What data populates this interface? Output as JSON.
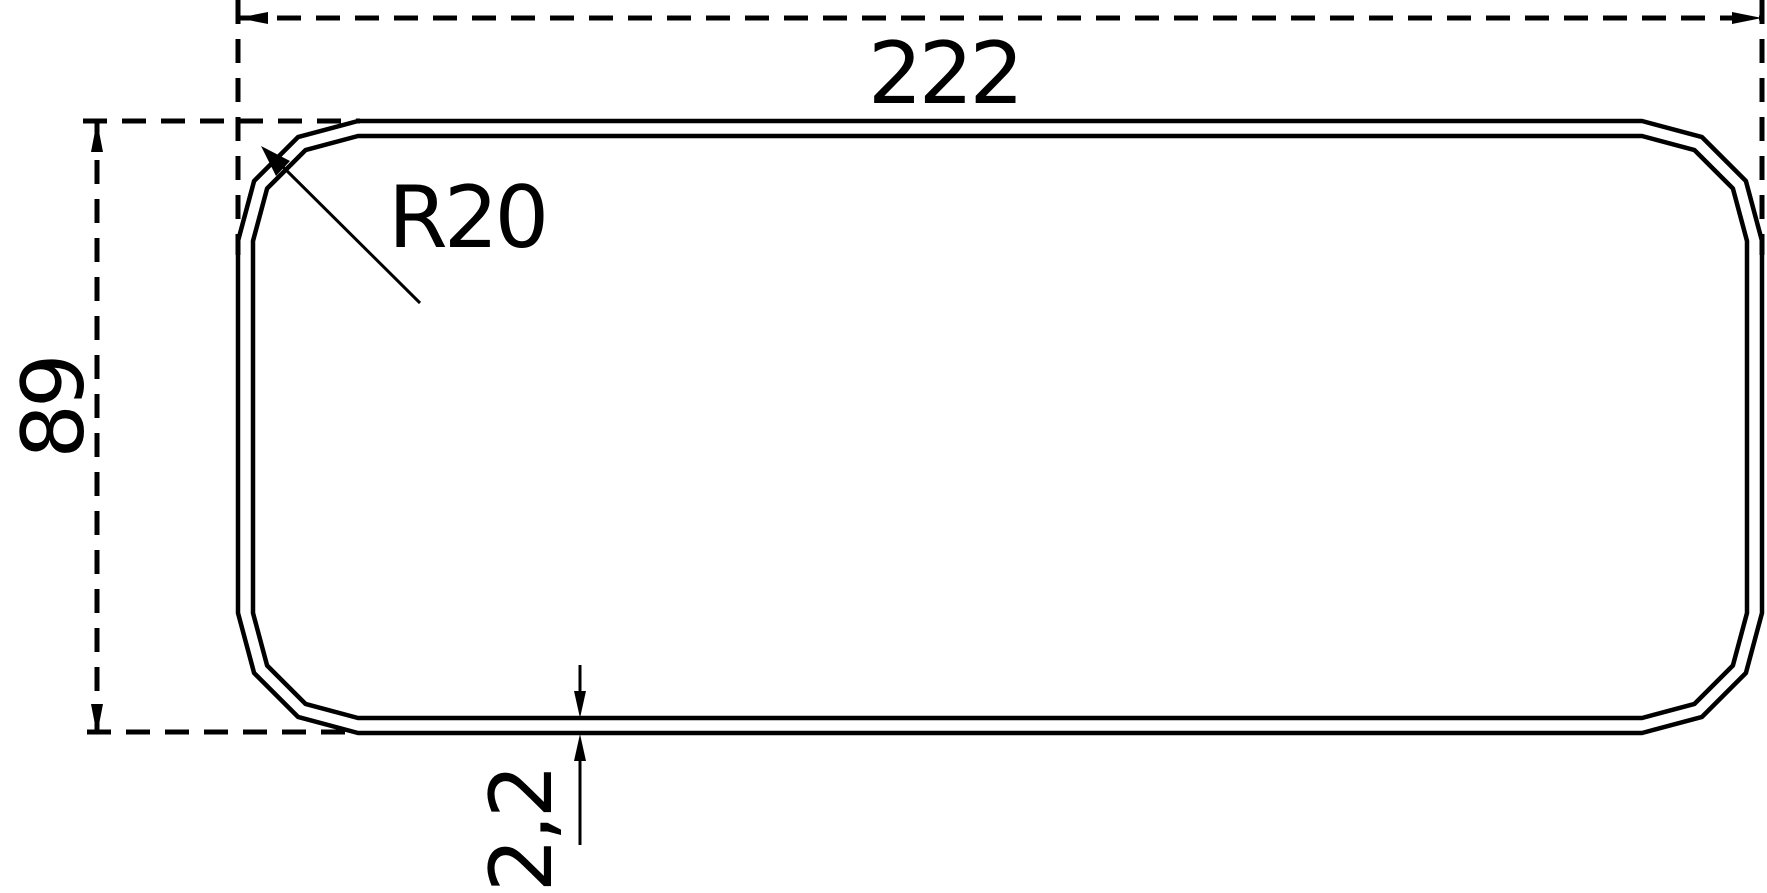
{
  "drawing": {
    "type": "technical-cross-section",
    "background_color": "#ffffff",
    "line_color": "#000000",
    "dimensions": {
      "width": {
        "label": "222",
        "value": 222
      },
      "height": {
        "label": "89",
        "value": 89
      },
      "corner_radius": {
        "label": "R20",
        "value": 20
      },
      "wall_thickness": {
        "label": "2,2",
        "value": 2.2
      }
    }
  }
}
